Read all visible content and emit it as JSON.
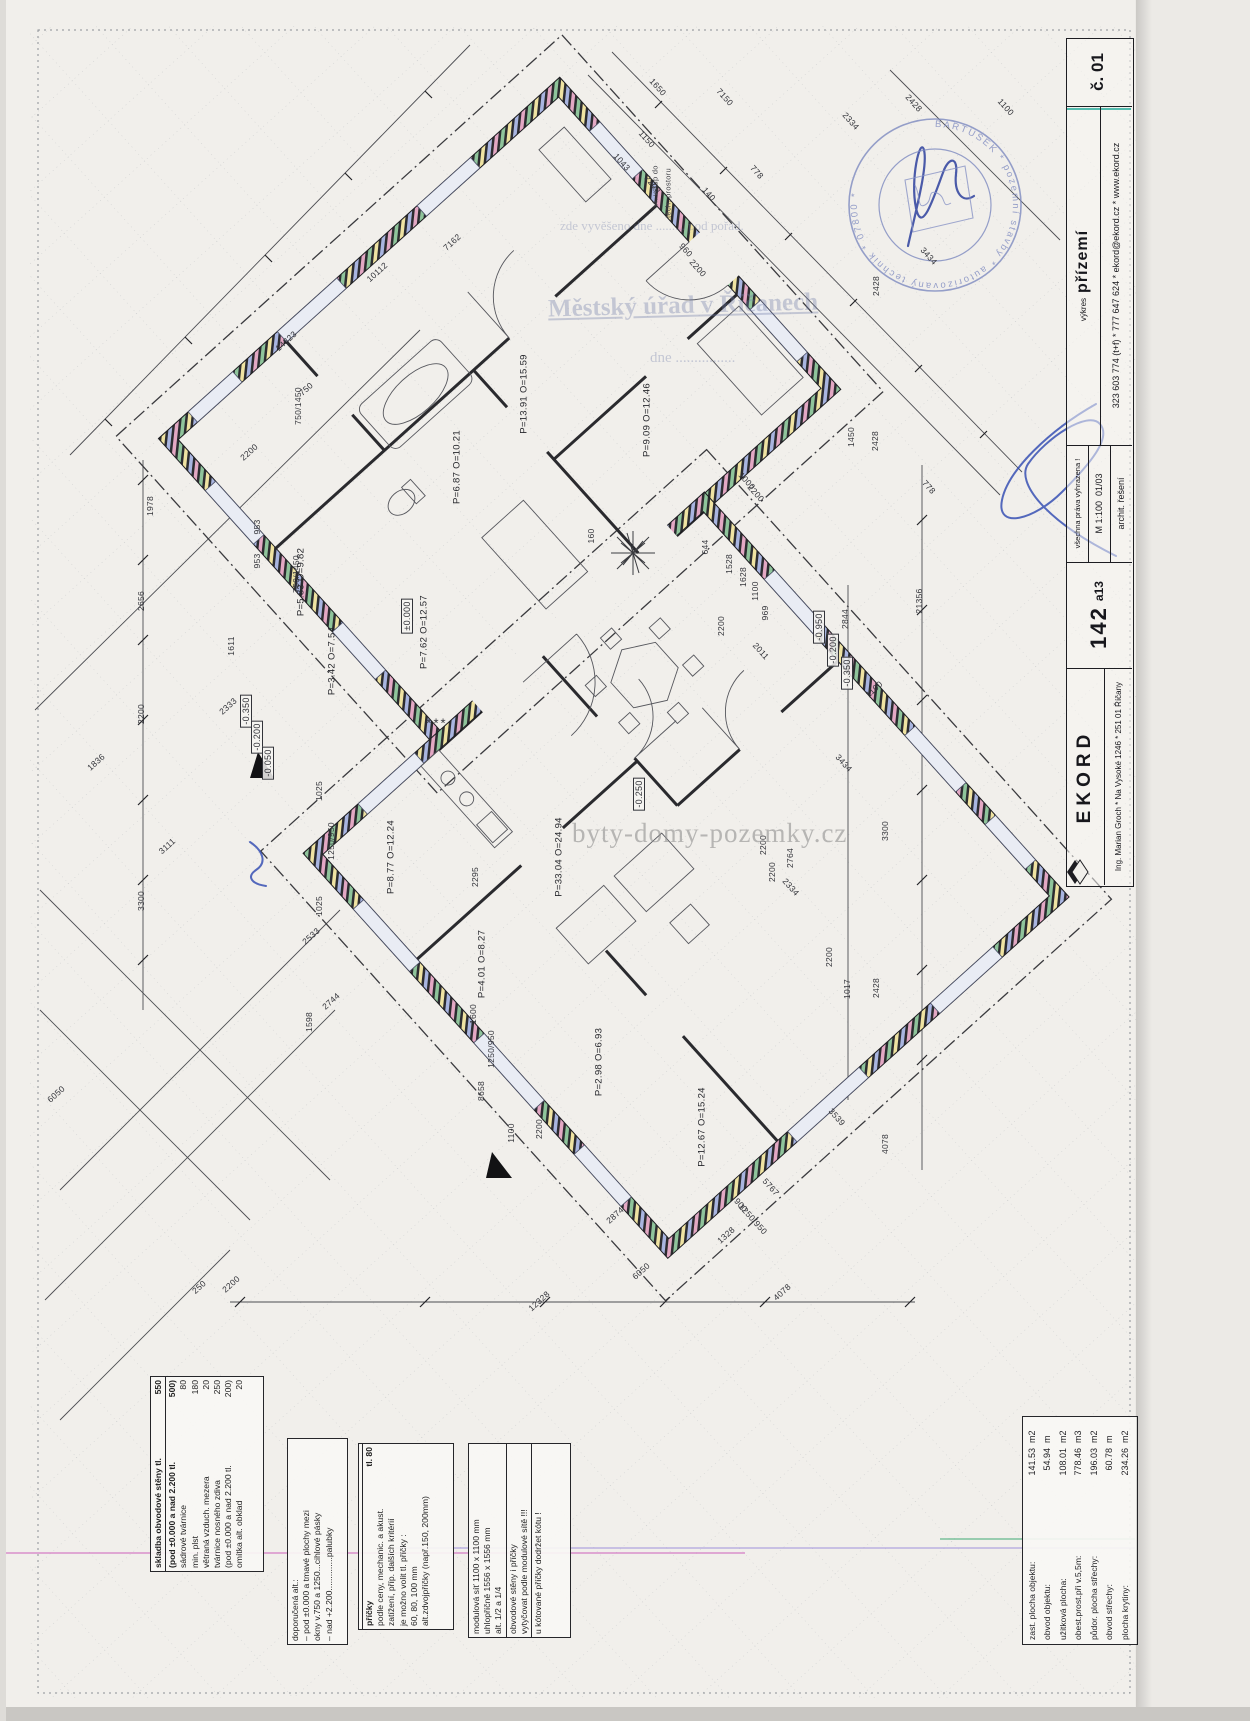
{
  "title_block": {
    "sheet_no": "č. 01",
    "contact": "323 603 774 (t+f) * 777 647 624 * ekord@ekord.cz * www.ekord.cz",
    "drawing_label": "výkres",
    "drawing_name": "přízemí",
    "rights": "všechna práva vyhrazena !",
    "scale": "M 1:100",
    "date": "01/03",
    "discipline": "archit. řešení",
    "model": "142",
    "variant": "a13",
    "brand": "EKORD",
    "address": "Ing. Marian Groch * Na Vysoké 1246 * 251 01 Říčany"
  },
  "office_stamp": {
    "line_small": "zde vyvěšeno dne .........  pod pořad.",
    "line_big": "Městský úřad v Říčanech",
    "line_date": "dne ................"
  },
  "round_stamp": {
    "ring": "BARTUŠEK  *  pozemní stavby  *  autorizovaný technik  *  07800  *"
  },
  "watermark": "byty-domy-pozemky.cz",
  "area_table": {
    "rows": [
      {
        "label": "zast. plocha objektu:",
        "value": "141.53",
        "unit": "m2"
      },
      {
        "label": "obvod objektu:",
        "value": "54.94",
        "unit": "m"
      },
      {
        "label": "užitková plocha:",
        "value": "108.01",
        "unit": "m2"
      },
      {
        "label": "obest.prost.při v.5,5m:",
        "value": "778.46",
        "unit": "m3"
      },
      {
        "label": "půdor. plocha střechy:",
        "value": "196.03",
        "unit": "m2"
      },
      {
        "label": "obvod střechy:",
        "value": "60.78",
        "unit": "m"
      },
      {
        "label": "plocha krytiny:",
        "value": "234.26",
        "unit": "m2"
      }
    ]
  },
  "notes": {
    "wall": [
      {
        "l": "skladba obvodové stěny tl.",
        "v": "550",
        "h": 1
      },
      {
        "l": "(pod ±0.000 a nad 2.200 tl.",
        "v": "500)",
        "h": 1,
        "s": 1
      },
      {
        "l": "sádrové tvárnice",
        "v": "80"
      },
      {
        "l": "min. plst",
        "v": "180"
      },
      {
        "l": "větraná vzduch. mezera",
        "v": "20"
      },
      {
        "l": "tvárnice nosného zdiva",
        "v": "250"
      },
      {
        "l": "(pod ±0.000 a nad 2.200 tl.",
        "v": "200)"
      },
      {
        "l": "omítka alt. obklad",
        "v": "20"
      }
    ],
    "alt": [
      {
        "l": "doporučená alt.:"
      },
      {
        "l": "– pod ±0.000 a tmavé plochy mezi"
      },
      {
        "l": "   okny v.750 a 1250...cihlové pásky"
      },
      {
        "l": "– nad +2.200..............palubky"
      }
    ],
    "partitions": [
      {
        "l": "příčky",
        "v": "tl. 80",
        "h": 1,
        "s": 1
      },
      {
        "l": "podle ceny, mechanic. a akust."
      },
      {
        "l": "zatížení, příp. dalších kritérií"
      },
      {
        "l": "je možno volit tl. příčky :"
      },
      {
        "l": "60, 80, 100 mm"
      },
      {
        "l": "alt.zdvojpříčky (např.150, 200mm)"
      }
    ],
    "module": [
      {
        "l": "modulová síť 1100 x 1100 mm"
      },
      {
        "l": "uhlopříčně 1556 x 1556 mm"
      },
      {
        "l": "alt. 1/2 a 1/4"
      },
      {
        "l": "obvodové stěny i příčky",
        "s": 1
      },
      {
        "l": "vytyčovat podle modulové sítě !!!"
      },
      {
        "l": "u kótované příčky dodržet kótu !",
        "s": 1
      }
    ]
  },
  "annotations": [
    {
      "t": "7150",
      "x": 725,
      "y": 97,
      "r": 48,
      "c": "dim"
    },
    {
      "t": "1650",
      "x": 658,
      "y": 87,
      "r": 48,
      "c": "dim"
    },
    {
      "t": "2334",
      "x": 851,
      "y": 121,
      "r": 48,
      "c": "dim"
    },
    {
      "t": "2428",
      "x": 914,
      "y": 103,
      "r": 48,
      "c": "dim"
    },
    {
      "t": "1100",
      "x": 1006,
      "y": 107,
      "r": 48,
      "c": "dim"
    },
    {
      "t": "778",
      "x": 757,
      "y": 172,
      "r": 48,
      "c": "dim"
    },
    {
      "t": "1150",
      "x": 647,
      "y": 139,
      "r": 48,
      "c": "dim"
    },
    {
      "t": "1043",
      "x": 622,
      "y": 162,
      "r": 48,
      "c": "dim"
    },
    {
      "t": "2200",
      "x": 653,
      "y": 184,
      "r": 48,
      "c": "dim"
    },
    {
      "t": "140",
      "x": 709,
      "y": 194,
      "r": 48,
      "c": "dim"
    },
    {
      "t": "960",
      "x": 686,
      "y": 250,
      "r": 48,
      "c": "dim"
    },
    {
      "t": "2200",
      "x": 698,
      "y": 268,
      "r": 48,
      "c": "dim"
    },
    {
      "t": "7162",
      "x": 452,
      "y": 242,
      "r": -42,
      "c": "dim"
    },
    {
      "t": "10112",
      "x": 377,
      "y": 272,
      "r": -42,
      "c": "dim"
    },
    {
      "t": "14323",
      "x": 286,
      "y": 341,
      "r": -42,
      "c": "dim"
    },
    {
      "t": "750",
      "x": 306,
      "y": 389,
      "r": -42,
      "c": "dim"
    },
    {
      "t": "750/1450",
      "x": 298,
      "y": 406,
      "r": -90,
      "c": "dim"
    },
    {
      "t": "2200",
      "x": 249,
      "y": 452,
      "r": -42,
      "c": "dim"
    },
    {
      "t": "1978",
      "x": 150,
      "y": 506,
      "r": -90,
      "c": "dim"
    },
    {
      "t": "953",
      "x": 257,
      "y": 527,
      "r": -90,
      "c": "dim"
    },
    {
      "t": "953",
      "x": 257,
      "y": 561,
      "r": -90,
      "c": "dim"
    },
    {
      "t": "750/1450",
      "x": 296,
      "y": 574,
      "r": -90,
      "c": "dim"
    },
    {
      "t": "2656",
      "x": 141,
      "y": 601,
      "r": -90,
      "c": "dim"
    },
    {
      "t": "1611",
      "x": 231,
      "y": 646,
      "r": -90,
      "c": "dim"
    },
    {
      "t": "2333",
      "x": 228,
      "y": 706,
      "r": -42,
      "c": "dim"
    },
    {
      "t": "2200",
      "x": 141,
      "y": 714,
      "r": -90,
      "c": "dim"
    },
    {
      "t": "3111",
      "x": 167,
      "y": 846,
      "r": -42,
      "c": "dim"
    },
    {
      "t": "1836",
      "x": 96,
      "y": 762,
      "r": -42,
      "c": "dim"
    },
    {
      "t": "3300",
      "x": 141,
      "y": 901,
      "r": -90,
      "c": "dim"
    },
    {
      "t": "1025",
      "x": 319,
      "y": 791,
      "r": -90,
      "c": "dim"
    },
    {
      "t": "1250/950",
      "x": 331,
      "y": 841,
      "r": -90,
      "c": "dim"
    },
    {
      "t": "1025",
      "x": 319,
      "y": 906,
      "r": -90,
      "c": "dim"
    },
    {
      "t": "2533",
      "x": 311,
      "y": 936,
      "r": -42,
      "c": "dim"
    },
    {
      "t": "2744",
      "x": 331,
      "y": 1001,
      "r": -42,
      "c": "dim"
    },
    {
      "t": "1598",
      "x": 309,
      "y": 1022,
      "r": -90,
      "c": "dim"
    },
    {
      "t": "6050",
      "x": 56,
      "y": 1094,
      "r": -42,
      "c": "dim"
    },
    {
      "t": "8658",
      "x": 481,
      "y": 1091,
      "r": -90,
      "c": "dim"
    },
    {
      "t": "1600",
      "x": 473,
      "y": 1014,
      "r": -90,
      "c": "dim"
    },
    {
      "t": "1250/950",
      "x": 491,
      "y": 1049,
      "r": -90,
      "c": "dim"
    },
    {
      "t": "1100",
      "x": 511,
      "y": 1133,
      "r": -90,
      "c": "dim"
    },
    {
      "t": "2200",
      "x": 539,
      "y": 1129,
      "r": -90,
      "c": "dim"
    },
    {
      "t": "250",
      "x": 199,
      "y": 1287,
      "r": -42,
      "c": "dim"
    },
    {
      "t": "2200",
      "x": 231,
      "y": 1284,
      "r": -42,
      "c": "dim"
    },
    {
      "t": "12328",
      "x": 539,
      "y": 1301,
      "r": -42,
      "c": "dim"
    },
    {
      "t": "6050",
      "x": 641,
      "y": 1271,
      "r": -42,
      "c": "dim"
    },
    {
      "t": "4078",
      "x": 782,
      "y": 1292,
      "r": -42,
      "c": "dim"
    },
    {
      "t": "1328",
      "x": 726,
      "y": 1235,
      "r": -42,
      "c": "dim"
    },
    {
      "t": "2874",
      "x": 615,
      "y": 1215,
      "r": -42,
      "c": "dim"
    },
    {
      "t": "5767",
      "x": 771,
      "y": 1187,
      "r": 48,
      "c": "dim"
    },
    {
      "t": "3539",
      "x": 837,
      "y": 1117,
      "r": 48,
      "c": "dim"
    },
    {
      "t": "900",
      "x": 741,
      "y": 1205,
      "r": 48,
      "c": "dim"
    },
    {
      "t": "1250/950",
      "x": 753,
      "y": 1219,
      "r": 48,
      "c": "dim"
    },
    {
      "t": "4078",
      "x": 885,
      "y": 1144,
      "r": -90,
      "c": "dim"
    },
    {
      "t": "2428",
      "x": 876,
      "y": 988,
      "r": -90,
      "c": "dim"
    },
    {
      "t": "1017",
      "x": 847,
      "y": 989,
      "r": -90,
      "c": "dim"
    },
    {
      "t": "2200",
      "x": 829,
      "y": 957,
      "r": -90,
      "c": "dim"
    },
    {
      "t": "2200",
      "x": 763,
      "y": 845,
      "r": -90,
      "c": "dim"
    },
    {
      "t": "2200",
      "x": 772,
      "y": 872,
      "r": -90,
      "c": "dim"
    },
    {
      "t": "2764",
      "x": 790,
      "y": 858,
      "r": -90,
      "c": "dim"
    },
    {
      "t": "3300",
      "x": 885,
      "y": 831,
      "r": -90,
      "c": "dim"
    },
    {
      "t": "2334",
      "x": 791,
      "y": 887,
      "r": 48,
      "c": "dim"
    },
    {
      "t": "3434",
      "x": 844,
      "y": 763,
      "r": 48,
      "c": "dim"
    },
    {
      "t": "1100",
      "x": 874,
      "y": 689,
      "r": -42,
      "c": "dim"
    },
    {
      "t": "2011",
      "x": 761,
      "y": 651,
      "r": 48,
      "c": "dim"
    },
    {
      "t": "21356",
      "x": 919,
      "y": 601,
      "r": -90,
      "c": "dim"
    },
    {
      "t": "2844",
      "x": 845,
      "y": 619,
      "r": -90,
      "c": "dim"
    },
    {
      "t": "778",
      "x": 929,
      "y": 487,
      "r": 48,
      "c": "dim"
    },
    {
      "t": "2428",
      "x": 875,
      "y": 441,
      "r": -90,
      "c": "dim"
    },
    {
      "t": "1450",
      "x": 851,
      "y": 437,
      "r": -90,
      "c": "dim"
    },
    {
      "t": "1000",
      "x": 747,
      "y": 481,
      "r": 48,
      "c": "dim"
    },
    {
      "t": "2200",
      "x": 756,
      "y": 493,
      "r": 48,
      "c": "dim"
    },
    {
      "t": "644",
      "x": 705,
      "y": 547,
      "r": -90,
      "c": "dim"
    },
    {
      "t": "1528",
      "x": 729,
      "y": 564,
      "r": -90,
      "c": "dim"
    },
    {
      "t": "1628",
      "x": 743,
      "y": 577,
      "r": -90,
      "c": "dim"
    },
    {
      "t": "1100",
      "x": 755,
      "y": 591,
      "r": -90,
      "c": "dim"
    },
    {
      "t": "969",
      "x": 765,
      "y": 613,
      "r": -90,
      "c": "dim"
    },
    {
      "t": "160",
      "x": 591,
      "y": 536,
      "r": -90,
      "c": "dim"
    },
    {
      "t": "2200",
      "x": 721,
      "y": 626,
      "r": -90,
      "c": "dim"
    },
    {
      "t": "3434",
      "x": 929,
      "y": 256,
      "r": 48,
      "c": "dim"
    },
    {
      "t": "2428",
      "x": 876,
      "y": 286,
      "r": -90,
      "c": "dim"
    },
    {
      "t": "2295",
      "x": 475,
      "y": 877,
      "r": -90,
      "c": "dim"
    },
    {
      "t": "***",
      "x": 437,
      "y": 723,
      "r": 0,
      "c": "dim big"
    },
    {
      "t": "vl. vstup do",
      "x": 655,
      "y": 186,
      "r": -90,
      "c": "note"
    },
    {
      "t": "tech. prostoru",
      "x": 668,
      "y": 193,
      "r": -90,
      "c": "note"
    },
    {
      "t": "P=13.91 O=15.59",
      "x": 524,
      "y": 394,
      "r": -90,
      "c": "room"
    },
    {
      "t": "P=9.09 O=12.46",
      "x": 647,
      "y": 420,
      "r": -90,
      "c": "room"
    },
    {
      "t": "P=6.87 O=10.21",
      "x": 457,
      "y": 467,
      "r": -90,
      "c": "room"
    },
    {
      "t": "P=5.83 O=9.82",
      "x": 301,
      "y": 582,
      "r": -90,
      "c": "room"
    },
    {
      "t": "P=3.42 O=7.54",
      "x": 332,
      "y": 661,
      "r": -90,
      "c": "room"
    },
    {
      "t": "P=7.62 O=12.57",
      "x": 424,
      "y": 632,
      "r": -90,
      "c": "room"
    },
    {
      "t": "P=8.77 O=12.24",
      "x": 391,
      "y": 857,
      "r": -90,
      "c": "room"
    },
    {
      "t": "P=33.04 O=24.94",
      "x": 559,
      "y": 857,
      "r": -90,
      "c": "room"
    },
    {
      "t": "P=4.01 O=8.27",
      "x": 482,
      "y": 964,
      "r": -90,
      "c": "room"
    },
    {
      "t": "P=2.98 O=6.93",
      "x": 599,
      "y": 1062,
      "r": -90,
      "c": "room"
    },
    {
      "t": "P=12.67 O=15.24",
      "x": 702,
      "y": 1127,
      "r": -90,
      "c": "room"
    },
    {
      "t": "±0.000",
      "x": 407,
      "y": 616,
      "r": -90,
      "c": "lvl"
    },
    {
      "t": "-0.250",
      "x": 639,
      "y": 794,
      "r": -90,
      "c": "lvl"
    },
    {
      "t": "-0.350",
      "x": 246,
      "y": 711,
      "r": -90,
      "c": "lvl"
    },
    {
      "t": "-0.200",
      "x": 257,
      "y": 737,
      "r": -90,
      "c": "lvl"
    },
    {
      "t": "-0.050",
      "x": 268,
      "y": 763,
      "r": -90,
      "c": "lvl"
    },
    {
      "t": "-0.950",
      "x": 819,
      "y": 627,
      "r": -90,
      "c": "lvl"
    },
    {
      "t": "-0.200",
      "x": 833,
      "y": 650,
      "r": -90,
      "c": "lvl"
    },
    {
      "t": "-0.350",
      "x": 847,
      "y": 673,
      "r": -90,
      "c": "lvl"
    }
  ]
}
